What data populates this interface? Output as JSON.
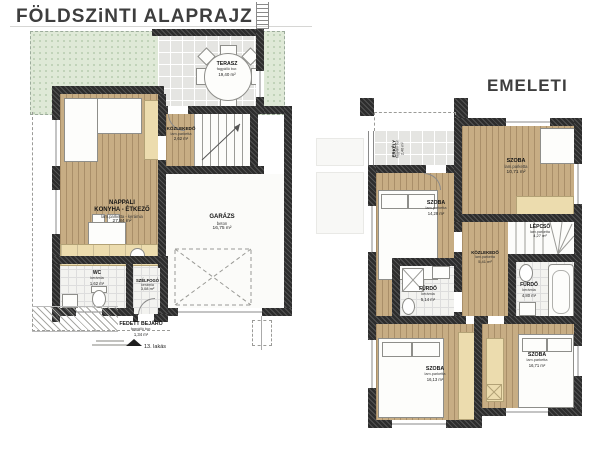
{
  "colors": {
    "wall": "#2d2d2d",
    "wood_floor": "#c7ad84",
    "terrace_tile": "#e5e5e2",
    "bath_tile": "#f3f3f0",
    "garden": "#dfe9d7",
    "furniture_beige": "#ecdcae"
  },
  "ground": {
    "title": "FÖLDSZiNTI ALAPRAJZ",
    "caption_unit": "13. lakás",
    "rooms": {
      "terasz": {
        "name": "TERASZ",
        "material": "fagyálló bur.",
        "area": "19,40 m²"
      },
      "kozlekedo": {
        "name": "KÖZLEKEDŐ",
        "material": "lam.parketta",
        "area": "2,62 m²"
      },
      "nappali": {
        "name": "NAPPALI\nKONYHA - ÉTKEZŐ",
        "material": "lam.parketta - kerámia",
        "area": "27,84 m²"
      },
      "garazs": {
        "name": "GARÁZS",
        "material": "beton",
        "area": "16,75 m²"
      },
      "wc": {
        "name": "WC",
        "material": "kerámia",
        "area": "1,62 m²"
      },
      "szelfogo": {
        "name": "SZÉLFOGÓ",
        "material": "kerámia",
        "area": "3,08 m²"
      },
      "fedett_bejaro": {
        "name": "FEDETT BEJÁRÓ",
        "material": "fagyálló bur.",
        "area": "1,34 m²"
      }
    }
  },
  "upper": {
    "title": "EMELETI",
    "rooms": {
      "erkely": {
        "name": "ERKÉLY",
        "material": "fagyálló bur.",
        "area": "2,40 m²"
      },
      "szoba_ej": {
        "name": "SZOBA",
        "material": "lam.parketta",
        "area": "10,71 m²"
      },
      "lepcso": {
        "name": "LÉPCSŐ",
        "material": "lam.parketta",
        "area": "4,27 m²"
      },
      "kozlekedo": {
        "name": "KÖZLEKEDŐ",
        "material": "lam.parketta",
        "area": "5,41 m²"
      },
      "szoba_bal": {
        "name": "SZOBA",
        "material": "lam.parketta",
        "area": "14,28 m²"
      },
      "furdo_bal": {
        "name": "FÜRDŐ",
        "material": "kerámia",
        "area": "5,14 m²"
      },
      "furdo_jobb": {
        "name": "FÜRDŐ",
        "material": "kerámia",
        "area": "4,80 m²"
      },
      "szoba_dbal": {
        "name": "SZOBA",
        "material": "lam.parketta",
        "area": "16,13 m²"
      },
      "szoba_djobb": {
        "name": "SZOBA",
        "material": "lam.parketta",
        "area": "16,71 m²"
      }
    }
  }
}
